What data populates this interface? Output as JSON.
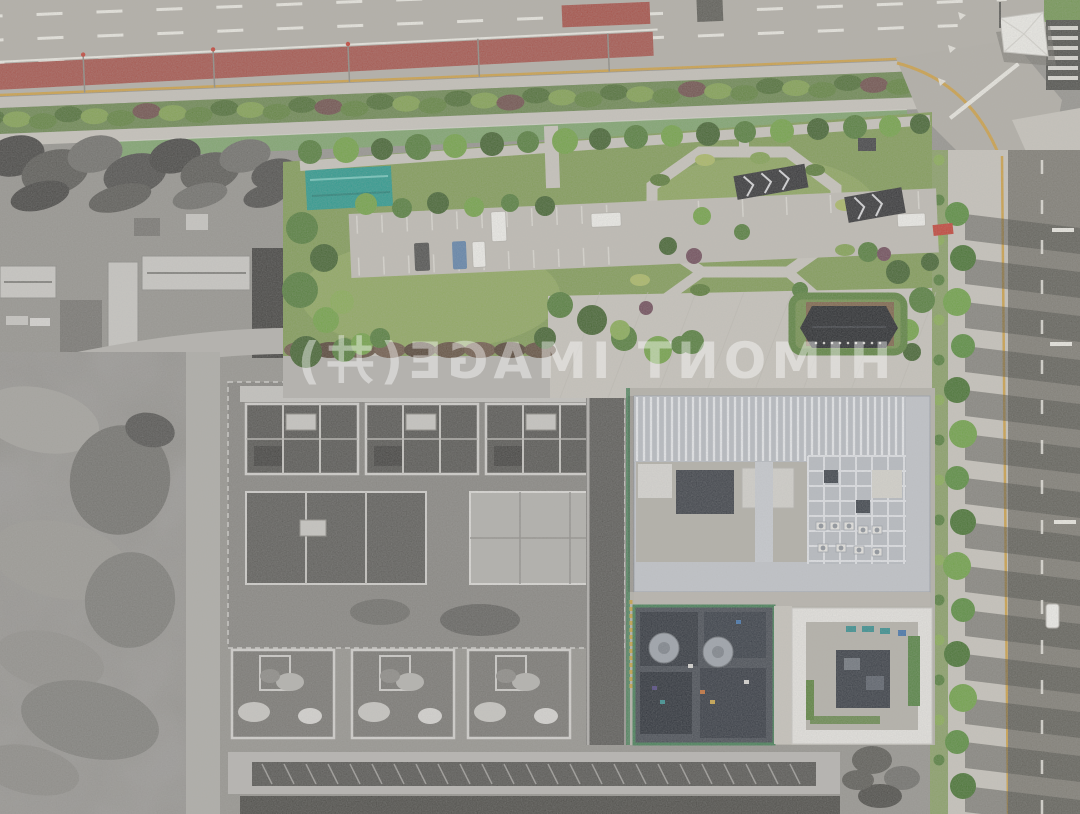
{
  "image": {
    "kind": "aerial-photograph",
    "subject": "Drone top-down view of an urban block: a landscaped public park and tree-lined avenue in full color beside a desaturated (grayscale) construction site with concrete building shells and earthworks; a multi-lane highway with a red bus lane and green cycle track runs along the top",
    "width_px": 1080,
    "height_px": 814,
    "color_treatment": "left/construction portion grayscale, park and new buildings in color"
  },
  "watermark": {
    "text": "HIMONT IMAGE(井)",
    "mirrored": true,
    "opacity": 0.42,
    "color": "rgba(255,255,255,0.42)"
  },
  "scene": {
    "regions": [
      {
        "name": "top-highway",
        "label": "Multi-lane highway with dashed lane lines, red bus lane and green cycle track"
      },
      {
        "name": "street-intersection",
        "label": "Corner intersection with zebra crossings and a white tensile canopy"
      },
      {
        "name": "right-avenue",
        "label": "Tree-lined avenue with long tree shadows across the roadway"
      },
      {
        "name": "public-park",
        "label": "Landscaped park: lawns, angular promenade, parking lot, dark pergolas, pavilion"
      },
      {
        "name": "grayscale-construction",
        "label": "Desaturated zone: old warehouses, excavated earth, concrete tower shells"
      },
      {
        "name": "modern-building-complex",
        "label": "White louvered-roof office complex with courtyards and HVAC units"
      },
      {
        "name": "construction-silos",
        "label": "Dark-roofed building under construction with two silver silos and green safety mesh"
      }
    ],
    "vehicles": [
      {
        "color": "white",
        "location": "highway, top of frame"
      },
      {
        "color": "white",
        "location": "park parking lot"
      },
      {
        "color": "blue",
        "location": "park parking lot"
      },
      {
        "color": "dark gray",
        "location": "park parking lot"
      },
      {
        "color": "white van",
        "location": "parking lot, east end"
      },
      {
        "color": "white",
        "location": "right avenue"
      }
    ],
    "landmarks": [
      {
        "name": "red-sign",
        "label": "Small red sign/sculpture at park east entrance"
      },
      {
        "name": "teal-net",
        "label": "Teal construction netting patch at park west edge"
      },
      {
        "name": "dark-pavilion",
        "label": "Dark-roofed pavilion in hedged garden, park south-east"
      }
    ]
  },
  "palette": {
    "gs_base": "#94928c",
    "gs_dark": "#43423f",
    "gs_mid": "#74726d",
    "gs_light": "#c9c7c2",
    "gs_dirt": "#8b8983",
    "gs_roof": "#cbc9c4",
    "road_asphalt": "#b3afa6",
    "road_mark": "#edebe3",
    "red_lane": "#a54e45",
    "orange_line": "#cf9f3f",
    "cycle_green": "#7ba368",
    "lawn": "#7e9a50",
    "lawn_light": "#95ae5e",
    "tree_green": "#4e7a33",
    "tree_bright": "#6ea13f",
    "tree_dark": "#3c5e27",
    "bush_yellow": "#aab95f",
    "hedge_brown": "#5e4a38",
    "paving": "#c9c5bc",
    "paving_dark": "#b2aea5",
    "teal_net": "#22978a",
    "avenue_road": "#7b786f",
    "shadow_dark": "#3e3d38",
    "louver_white": "#e9ebee",
    "bldg_gray": "#b8bcc2",
    "court_floor": "#b3b0a7",
    "navy_roof": "#272c34",
    "green_mesh": "#3c7a4e",
    "silo_gray": "#9ba1a9",
    "red_sign": "#c43b2e",
    "white": "#f2f1ec",
    "canopy_white": "#f0efe9",
    "watermark": "rgba(255,255,255,0.42)"
  }
}
